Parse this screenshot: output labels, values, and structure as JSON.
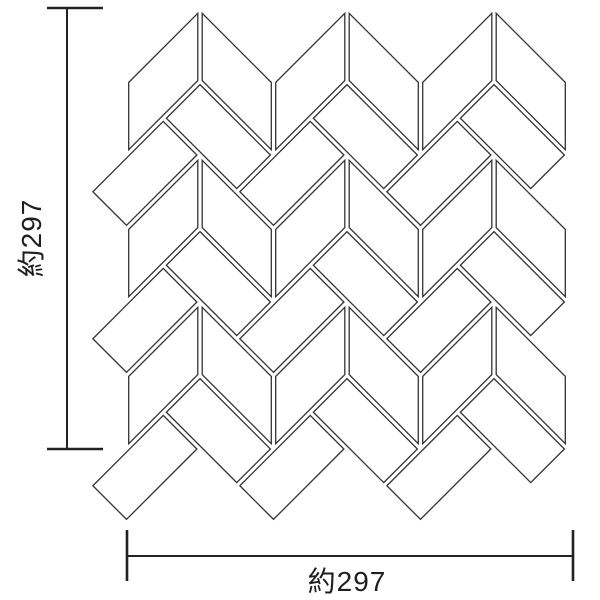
{
  "diagram": {
    "title": "mosaic-sheet-dimension-diagram",
    "canvas": {
      "width": 600,
      "height": 600,
      "background": "#ffffff"
    },
    "pattern": {
      "type": "chevron-herringbone-mosaic",
      "unit": 73.5,
      "origin": {
        "x": 200,
        "y": 8
      },
      "columns": 3,
      "rows": 3,
      "grout_inset": 2.2,
      "stroke_width": 1.3,
      "stroke_color": "#333333",
      "fill_color": "#ffffff",
      "tile_shapes": {
        "chevron_left": [
          [
            0,
            0
          ],
          [
            -1,
            1
          ],
          [
            -1,
            2
          ],
          [
            0,
            1
          ]
        ],
        "chevron_right": [
          [
            0,
            0
          ],
          [
            1,
            1
          ],
          [
            1,
            2
          ],
          [
            0,
            1
          ]
        ],
        "rect_down": [
          [
            0,
            1
          ],
          [
            1,
            2
          ],
          [
            0.5,
            2.5
          ],
          [
            -0.5,
            1.5
          ]
        ],
        "rect_up": [
          [
            0,
            2
          ],
          [
            -1,
            3
          ],
          [
            -1.5,
            2.5
          ],
          [
            -0.5,
            1.5
          ]
        ]
      }
    },
    "dimensions": {
      "color": "#222222",
      "line_width": 2,
      "cap_width": 2.6,
      "vertical": {
        "label": "約297",
        "line_x": 67,
        "y1": 8,
        "y2": 449,
        "cap_x1": 47,
        "cap_x2": 103,
        "label_x": 41,
        "label_y": 238
      },
      "horizontal": {
        "label": "約297",
        "line_y": 556,
        "x1": 127,
        "x2": 573,
        "cap_y1": 530,
        "cap_y2": 581,
        "label_x": 347,
        "label_y": 591
      }
    }
  }
}
